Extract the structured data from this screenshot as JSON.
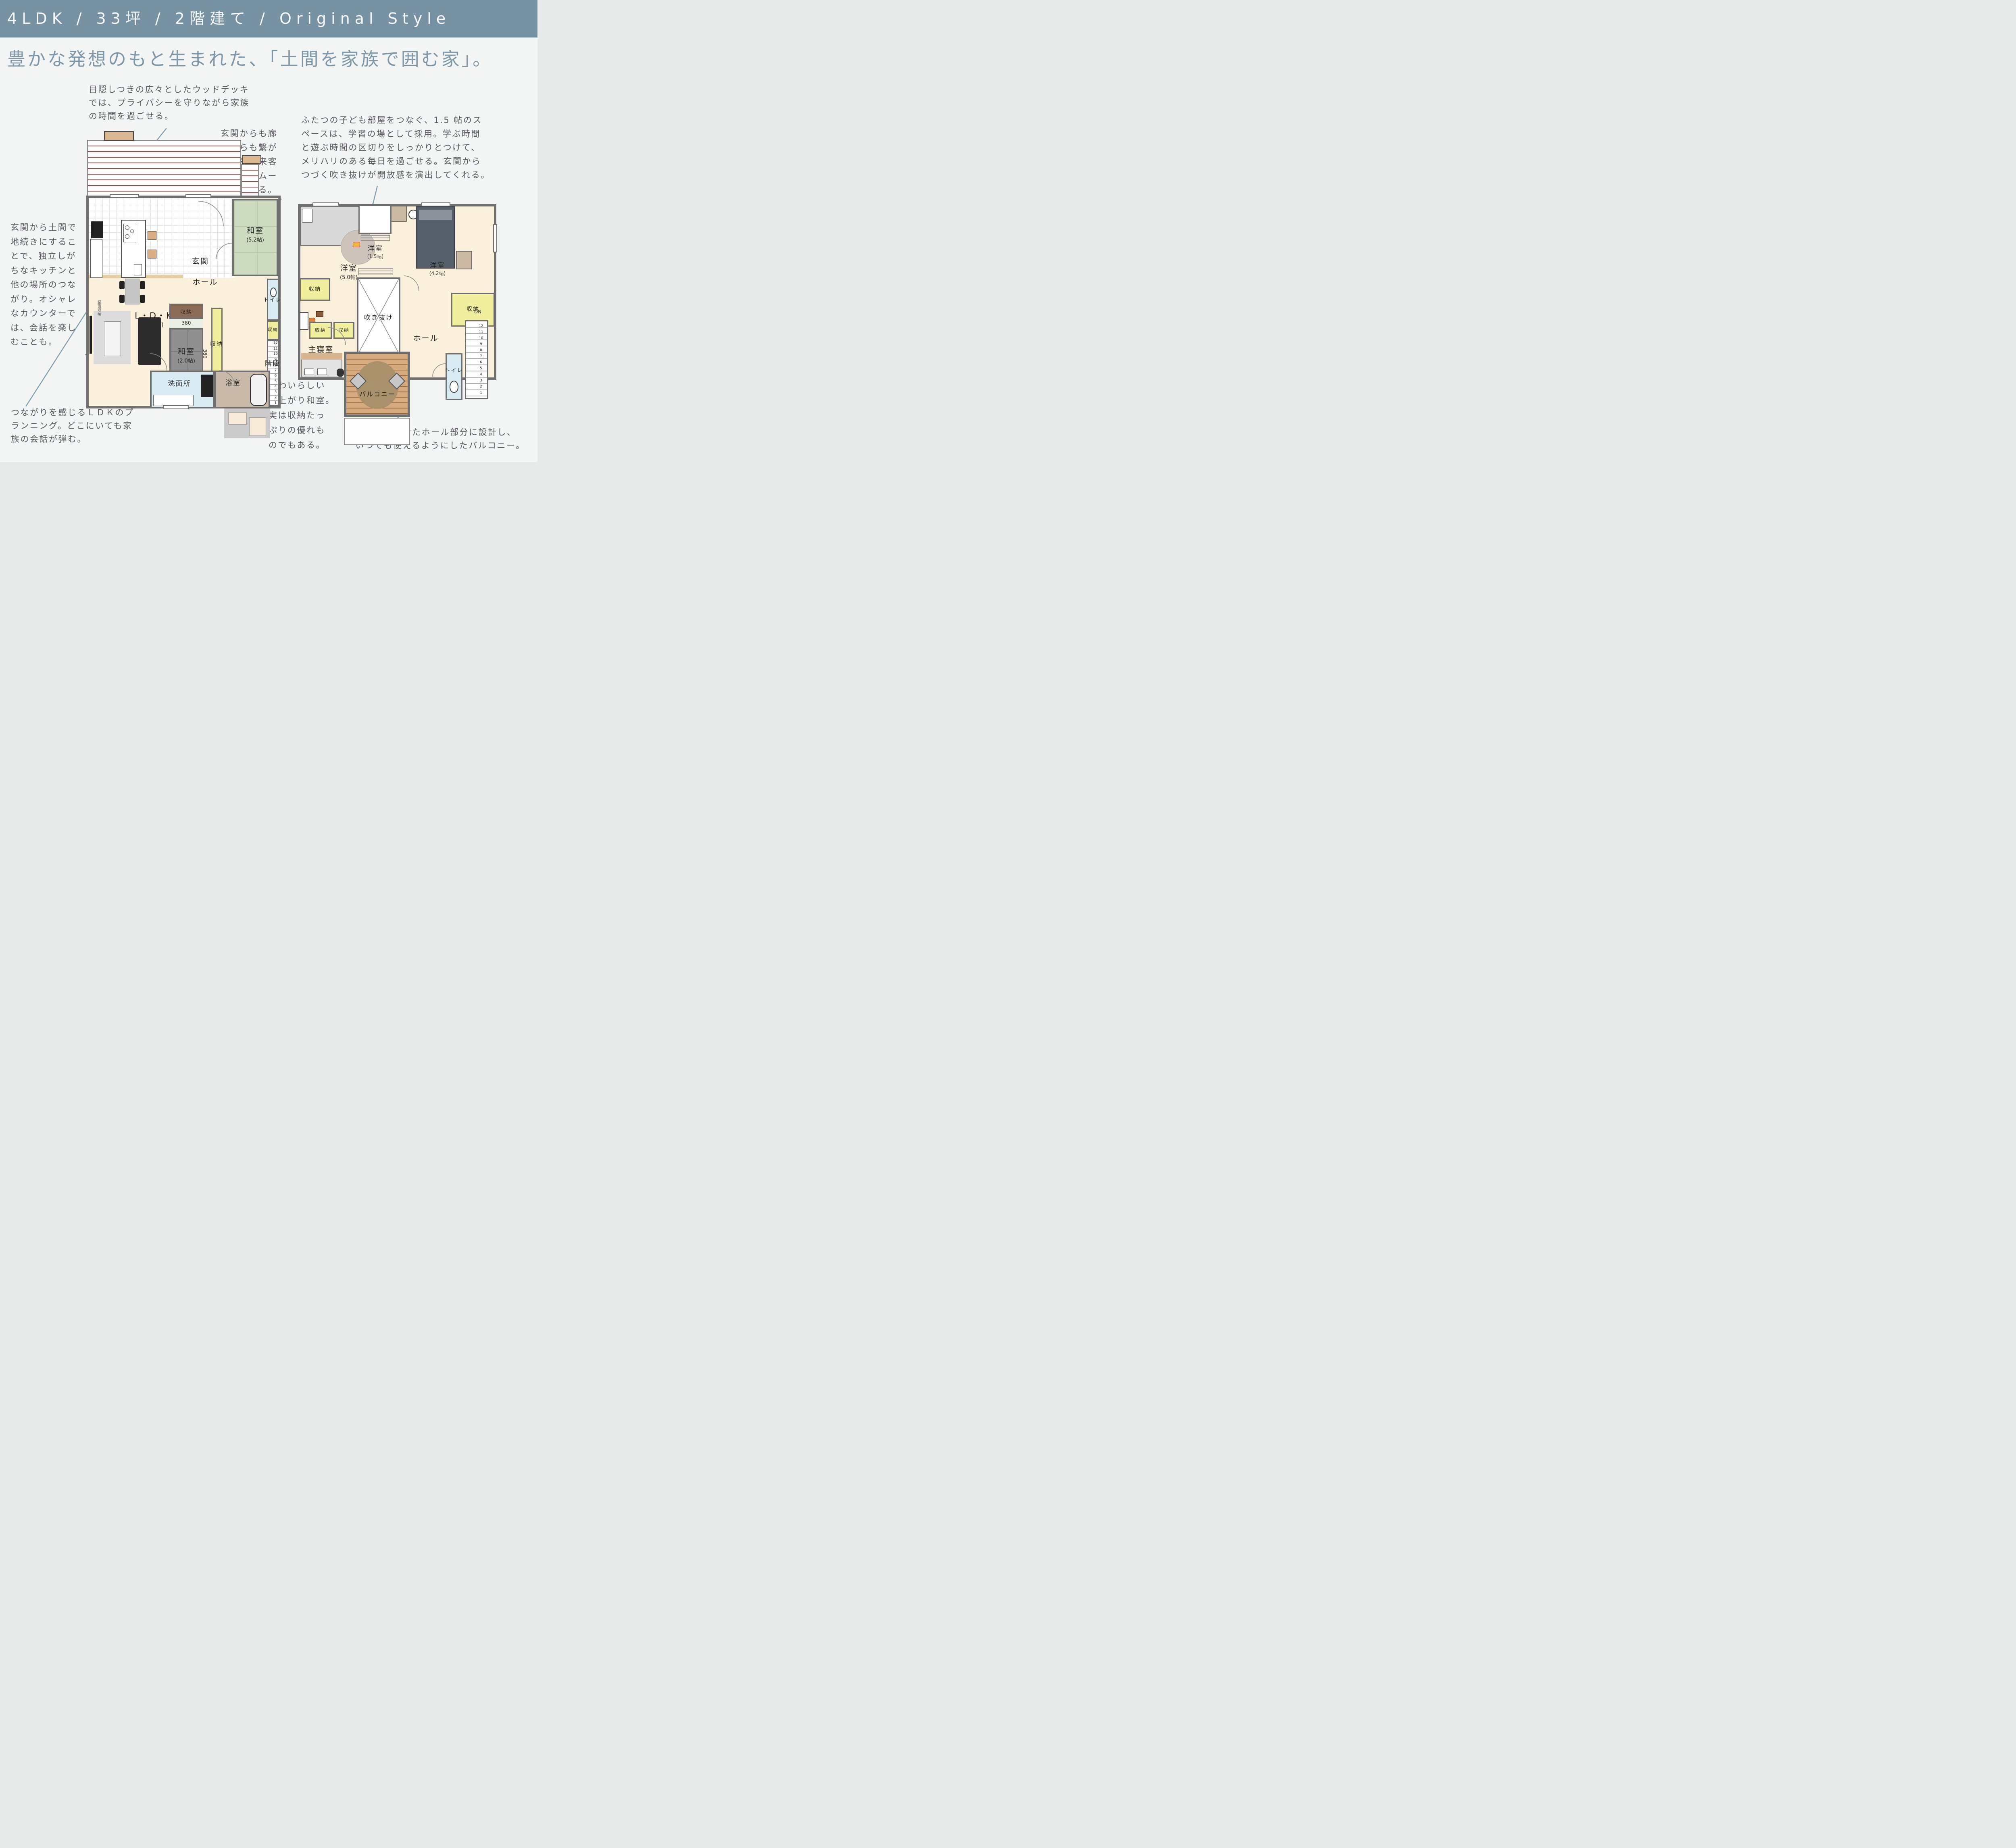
{
  "header": {
    "text": "4LDK / 33坪 / 2階建て / Original Style"
  },
  "title": {
    "text": "豊かな発想のもと生まれた、「土間を家族で囲む家」。"
  },
  "notes": {
    "wood_deck": {
      "text": "目隠しつきの広々としたウッドデッキ\nでは、プライバシーを守りながら家族\nの時間を過ごせる。"
    },
    "washitsu": {
      "text": "玄関からも廊\n下からも繋が\nる和室。来客\n対応もスムー\nズにできる。"
    },
    "kids_room": {
      "text": "ふたつの子ども部屋をつなぐ、1.5 帖のス\nペースは、学習の場として採用。学ぶ時間\nと遊ぶ時間の区切りをしっかりとつけて、\nメリハリのある毎日を過ごせる。玄関から\nつづく吹き抜けが開放感を演出してくれる。"
    },
    "doma": {
      "text": "玄関から土間で\n地続きにするこ\nとで、独立しが\nちなキッチンと\n他の場所のつな\nがり。オシャレ\nなカウンターで\nは、会話を楽し\nむことも。"
    },
    "ldk": {
      "text": "つながりを感じるＬＤＫのプ\nランニング。どこにいても家\n族の会話が弾む。"
    },
    "tatami_storage": {
      "text": "かわいらしい\n小上がり和室。\n実は収納たっ\nぷりの優れも\nのでもある。"
    },
    "balcony": {
      "text": "余裕を持たせたホール部分に設計し、\nいつでも使えるようにしたバルコニー。"
    }
  },
  "floor1": {
    "rooms": {
      "washitsu52": {
        "name": "和室",
        "size": "(5.2帖)"
      },
      "genkan": "玄関",
      "hall": "ホール",
      "ldk": {
        "name": "L・D・K",
        "size": "(8.5帖)"
      },
      "washitsu20": {
        "name": "和室",
        "size": "(2.0帖)"
      },
      "senmenjo": "洗面所",
      "bathroom": "浴室",
      "toilet": "トイレ",
      "stairs": "階段"
    },
    "labels": {
      "storage_brown": "収納",
      "storage_right": "収納",
      "storage_small": "収納",
      "dim_h": "380",
      "dim_v": "380",
      "up": "UP",
      "stair_numbers": "12\n11\n10\n9\n8\n7\n6\n5\n4\n3\n2\n1",
      "wall_storage": "壁面収納"
    }
  },
  "floor2": {
    "rooms": {
      "yoshitsu50": {
        "name": "洋室",
        "size": "(5.0帖)"
      },
      "yoshitsu15": {
        "name": "洋室",
        "size": "(1.5帖)"
      },
      "yoshitsu42": {
        "name": "洋室",
        "size": "(4.2帖)"
      },
      "shushinshitsu": {
        "name": "主寝室",
        "size": "(6.0帖)"
      },
      "hall": "ホール",
      "void": "吹き抜け",
      "balcony": "バルコニー",
      "toilet": "トイレ"
    },
    "labels": {
      "storage_a": "収納",
      "storage_b": "収納",
      "storage_c": "収納",
      "storage_d": "収納",
      "dn": "DN",
      "stair_numbers": "12\n11\n10\n9\n8\n7\n6\n5\n4\n3\n2\n1"
    }
  },
  "colors": {
    "accent_bar": "#7792a2",
    "title": "#7e98a9",
    "note_text": "#5a5761",
    "leader_line": "#7f9dae"
  }
}
